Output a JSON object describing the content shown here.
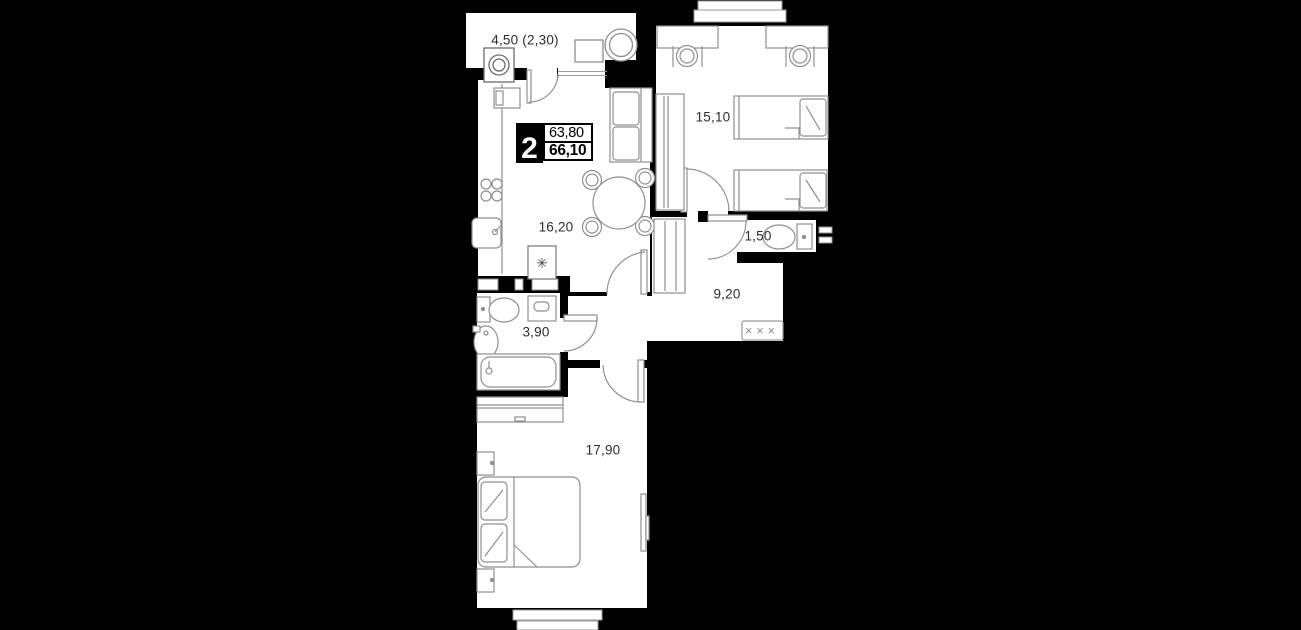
{
  "apartment": {
    "badge": {
      "rooms_count": "2",
      "area_living": "63,80",
      "area_total": "66,10"
    },
    "labels": {
      "balcony": "4,50 (2,30)",
      "kitchen_living": "16,20",
      "bedroom_top": "15,10",
      "wc": "1,50",
      "hallway": "9,20",
      "bathroom": "3,90",
      "bedroom_bottom": "17,90"
    },
    "symbols": {
      "boiler": "✳",
      "coat_hooks": "×××"
    },
    "colors": {
      "background": "#000000",
      "room_fill": "#ffffff",
      "wall": "#000000",
      "furniture_stroke": "#8f8f8f",
      "label_text": "#2d2d2d"
    }
  }
}
